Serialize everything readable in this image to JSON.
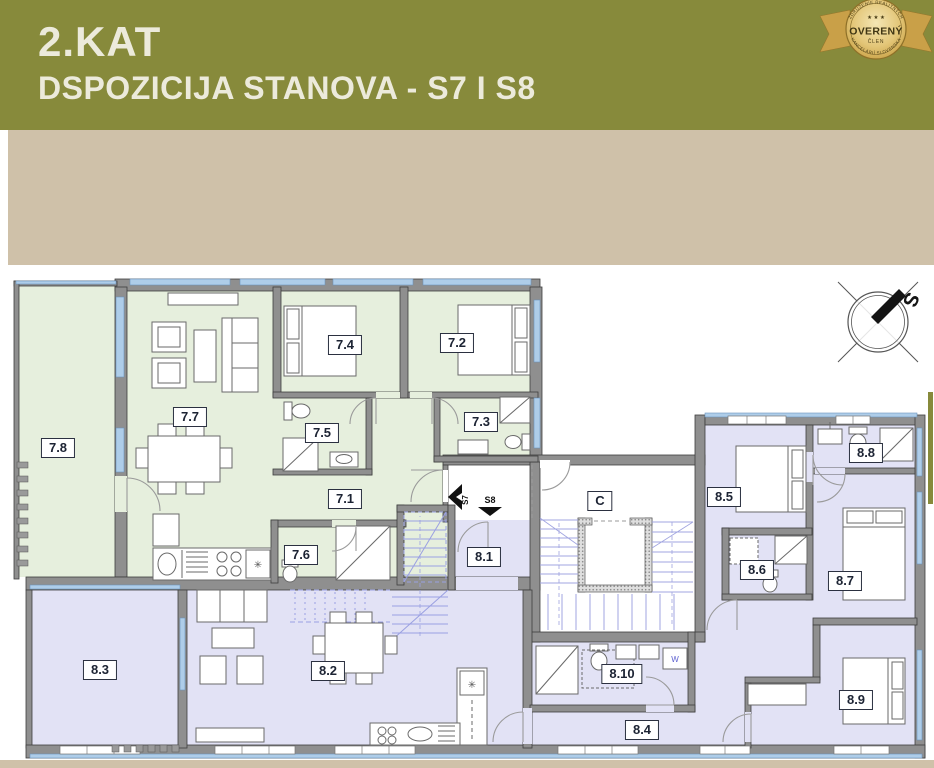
{
  "header": {
    "title": "2.KAT",
    "subtitle": "DSPOZICIJA STANOVA - S7 I S8"
  },
  "badge": {
    "arc_top": "ZDRUŽENIE REALITNÝCH",
    "arc_bottom": "KANCELÁRIÍ SLOVENSKA",
    "stars": "★ ★ ★",
    "title": "OVERENÝ",
    "subtitle": "ČLEN"
  },
  "plan": {
    "compass_north": "S",
    "stairwell": "C",
    "washer": "W",
    "entrance_s7": "S7",
    "entrance_s8": "S8",
    "rooms": {
      "r71": "7.1",
      "r72": "7.2",
      "r73": "7.3",
      "r74": "7.4",
      "r75": "7.5",
      "r76": "7.6",
      "r77": "7.7",
      "r78": "7.8",
      "r81": "8.1",
      "r82": "8.2",
      "r83": "8.3",
      "r84": "8.4",
      "r85": "8.5",
      "r86": "8.6",
      "r87": "8.7",
      "r88": "8.8",
      "r89": "8.9",
      "r810": "8.10"
    }
  },
  "colors": {
    "header_olive": "#878a3b",
    "band_beige": "#cfc1a9",
    "apartment_s7_tint": "#e6efdd",
    "apartment_s8_tint": "#e2e2f5",
    "window_blue": "#aecde9",
    "lower_floor_overlay_blue": "#9aa0e2",
    "wall_gray": "#8f8f8f",
    "badge_gold": "#d9b95e"
  }
}
